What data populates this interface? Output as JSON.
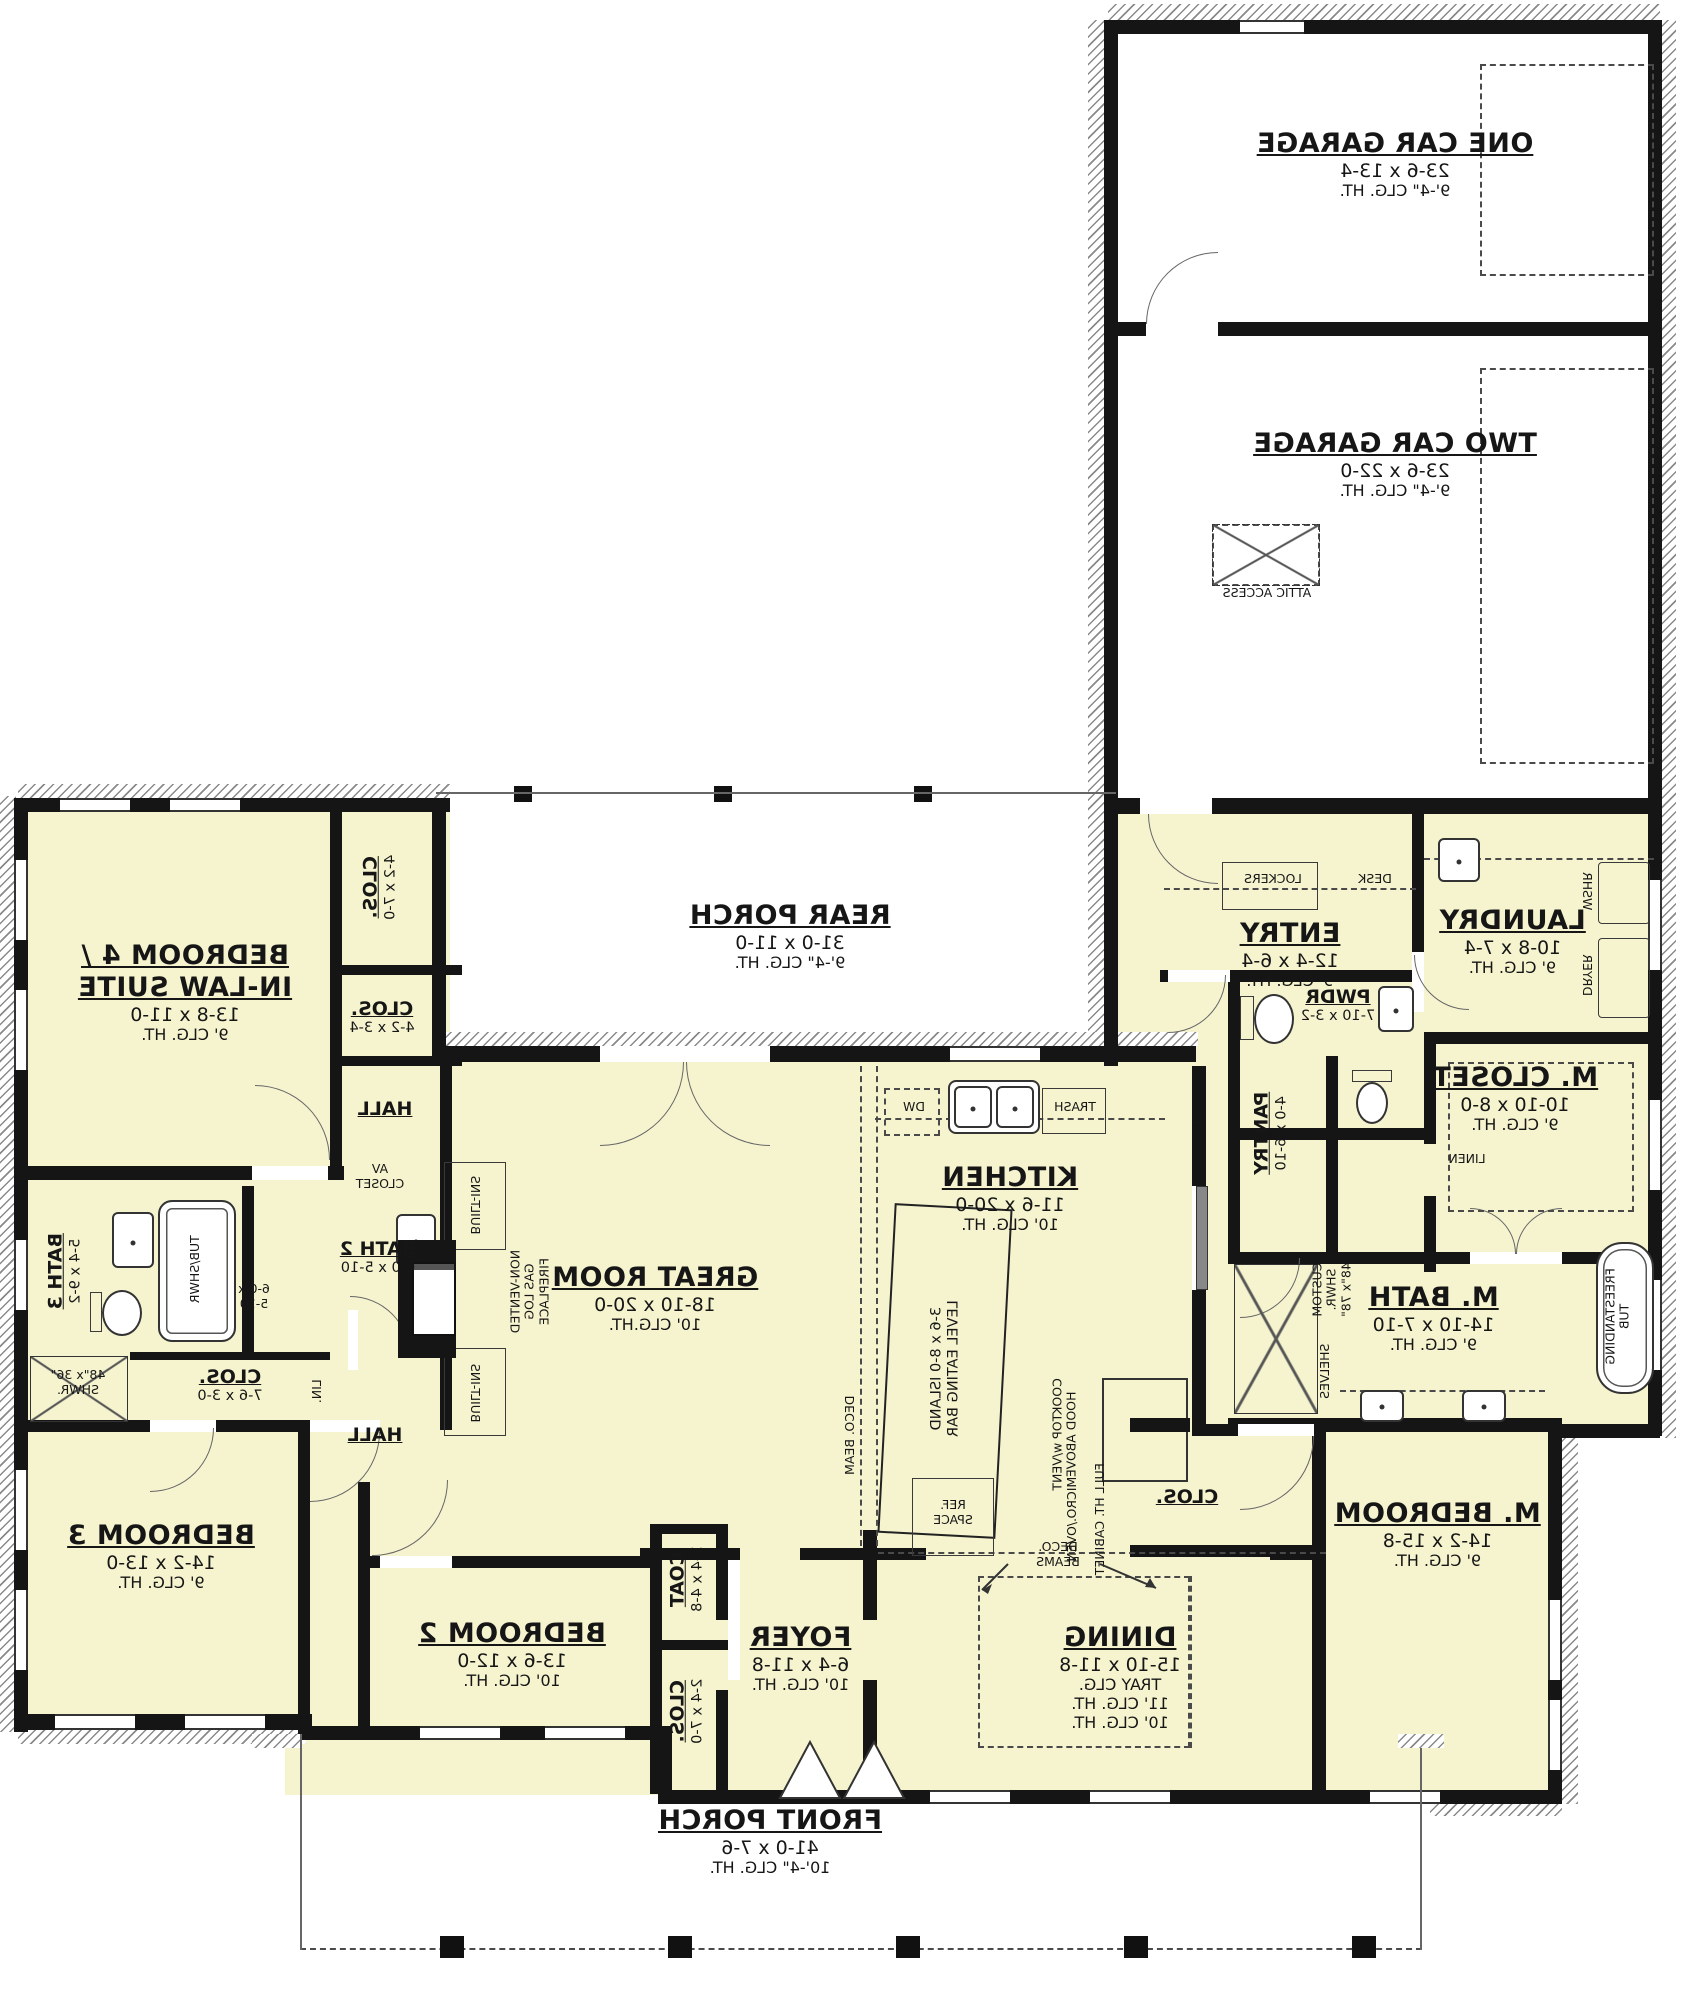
{
  "colors": {
    "room_fill": "#f6f4cf",
    "wall": "#151515",
    "background": "#ffffff"
  },
  "orientation_note": "plan rendered mirrored (horizontally flipped text)",
  "rooms": {
    "one_car_garage": {
      "name": "ONE CAR GARAGE",
      "dims": "23-6 x 13-4",
      "ceil": "9'-4\" CLG. HT."
    },
    "two_car_garage": {
      "name": "TWO CAR GARAGE",
      "dims": "23-6 x 22-0",
      "ceil": "9'-4\" CLG. HT."
    },
    "rear_porch": {
      "name": "REAR PORCH",
      "dims": "31-0 x 11-0",
      "ceil": "9'-4\" CLG. HT."
    },
    "front_porch": {
      "name": "FRONT PORCH",
      "dims": "41-0 x 7-6",
      "ceil": "10'-4\" CLG. HT."
    },
    "entry": {
      "name": "ENTRY",
      "dims": "12-4 x 6-4",
      "ceil": "9' CLG. HT."
    },
    "laundry": {
      "name": "LAUNDRY",
      "dims": "10-8 x 7-4",
      "ceil": "9' CLG. HT."
    },
    "pwdr": {
      "name": "PWDR",
      "dims": "7-10 x 3-2"
    },
    "pantry": {
      "name": "PANTRY",
      "dims": "4-0 x 6-10"
    },
    "m_closet": {
      "name": "M. CLOSET",
      "dims": "10-10 x 8-0",
      "ceil": "9' CLG. HT."
    },
    "m_bath": {
      "name": "M. BATH",
      "dims": "14-10 x 7-10",
      "ceil": "9' CLG. HT."
    },
    "m_bedroom": {
      "name": "M. BEDROOM",
      "dims": "14-2 x 15-8",
      "ceil": "9' CLG. HT."
    },
    "kitchen": {
      "name": "KITCHEN",
      "dims": "11-6 x 20-0",
      "ceil": "10' CLG. HT."
    },
    "great_room": {
      "name": "GREAT ROOM",
      "dims": "18-10 x 20-0",
      "ceil": "10' CLG.HT."
    },
    "dining": {
      "name": "DINING",
      "dims": "15-10 x 11-8",
      "tray": "TRAY CLG.",
      "ceil1": "11' CLG. HT.",
      "ceil2": "10' CLG. HT."
    },
    "foyer": {
      "name": "FOYER",
      "dims": "6-4 x 11-8",
      "ceil": "10' CLG. HT."
    },
    "bedroom2": {
      "name": "BEDROOM 2",
      "dims": "13-6 x 12-0",
      "ceil": "10' CLG. HT."
    },
    "bedroom3": {
      "name": "BEDROOM 3",
      "dims": "14-2 x 13-0",
      "ceil": "9' CLG. HT."
    },
    "bedroom4": {
      "name": "BEDROOM 4 /",
      "name2": "IN-LAW SUITE",
      "dims": "13-8 x 11-0",
      "ceil": "9' CLG. HT."
    },
    "bath2": {
      "name": "BATH 2",
      "dims": "6-0 x 5-10"
    },
    "bath3": {
      "name": "BATH 3",
      "dims": "5-4 x 9-2"
    },
    "clos_b4_top": {
      "name": "CLOS.",
      "dims": "4-2 x 7-0"
    },
    "clos_b4": {
      "name": "CLOS.",
      "dims": "4-2 x 3-4"
    },
    "clos_hall": {
      "name": "CLOS.",
      "dims": "7-6 x 3-0"
    },
    "coat": {
      "name": "COAT",
      "dims": "2-4 x 4-8"
    },
    "clos_foyer": {
      "name": "CLOS.",
      "dims": "2-4 x 7-0"
    },
    "clos_mbed": {
      "name": "CLOS."
    },
    "hall_b4": {
      "name": "HALL"
    },
    "hall_main": {
      "name": "HALL"
    }
  },
  "annotations": {
    "attic": "ATTIC ACCESS",
    "lockers": "LOCKERS",
    "desk": "DESK",
    "wshr": "WSHR",
    "dryer": "DRYER",
    "dw": "DW",
    "trash": "TRASH",
    "island1": "3-6 x 8-0 ISLAND",
    "island2": "LEVEL EATING BAR",
    "cooktop1": "COOKTOP w/VENT",
    "cooktop2": "HOOD ABOVE",
    "ref1": "REF.",
    "ref2": "SPACE",
    "micro": "MICRO./OVEN",
    "cabinet": "FULL HT. CABINET",
    "deco_beam": "DECO. BEAM",
    "deco_beams1": "DECO.",
    "deco_beams2": "BEAMS",
    "barn_door": "BARN DOOR",
    "linen": "LINEN",
    "lin": "LIN.",
    "custom_shwr1": "CUSTOM",
    "custom_shwr2": "SHWR.",
    "custom_shwr3": "48\"x 78\"",
    "shwr1": "48\"x 36\"",
    "shwr2": "SHWR.",
    "tubshwr": "TUB/SHWR",
    "bath2_size1": "6-0 x",
    "bath2_size2": "5-10",
    "fp1": "NON-VENTED",
    "fp2": "GAS LOG",
    "fp3": "FIREPLACE",
    "builtins": "BUILT-INS",
    "av1": "AV",
    "av2": "CLOSET",
    "freestanding1": "FREESTANDING",
    "freestanding2": "TUB",
    "shelves": "SHELVES"
  }
}
